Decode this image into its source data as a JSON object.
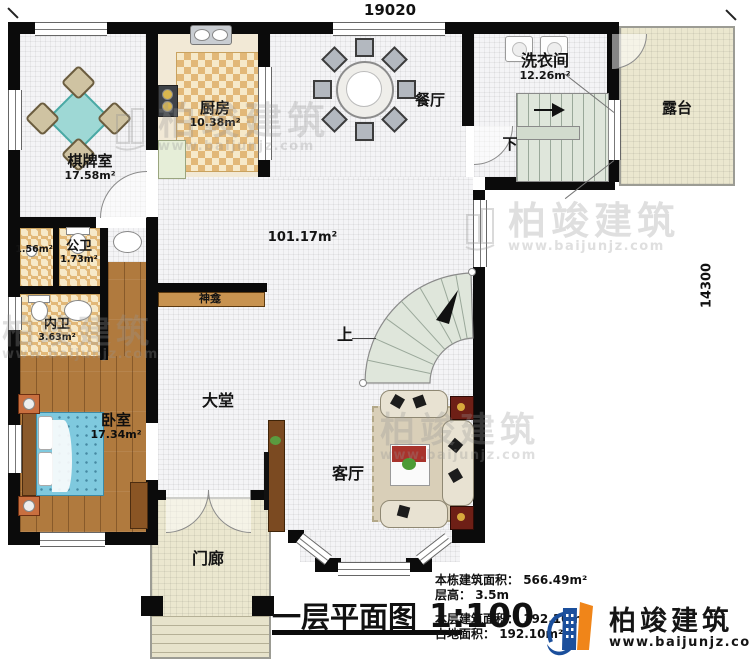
{
  "dimensions": {
    "top": "19020",
    "right": "14300"
  },
  "rooms": {
    "chess": {
      "name": "棋牌室",
      "area": "17.58m²"
    },
    "kitchen": {
      "name": "厨房",
      "area": "10.38m²"
    },
    "dining": {
      "name": "餐厅"
    },
    "laundry": {
      "name": "洗衣间",
      "area": "12.26m²"
    },
    "terrace": {
      "name": "露台"
    },
    "hall": {
      "area": "101.17m²"
    },
    "shower": {
      "area": "1.56m²"
    },
    "public_bath": {
      "name": "公卫",
      "area": "1.73m²"
    },
    "inner_bath": {
      "name": "内卫",
      "area": "3.63m²"
    },
    "bedroom": {
      "name": "卧室",
      "area": "17.34m²"
    },
    "lobby": {
      "name": "大堂"
    },
    "shrine": {
      "name": "神龛"
    },
    "living": {
      "name": "客厅"
    },
    "porch": {
      "name": "门廊"
    }
  },
  "stairs": {
    "up": "上",
    "down": "下"
  },
  "title": {
    "text": "一层平面图",
    "scale": "1:100"
  },
  "stats": [
    {
      "label": "本栋建筑面积：",
      "value": "566.49m²"
    },
    {
      "label": "层高：",
      "value": "3.5m"
    },
    {
      "label": "本层建筑面积：",
      "value": "192.10m²"
    },
    {
      "label": "占地面积：",
      "value": "192.10m²"
    }
  ],
  "brand": {
    "name": "柏竣建筑",
    "site": "www.baijunjz.com"
  },
  "watermark": {
    "name": "柏竣建筑",
    "site": "www.baijunjz.com"
  },
  "colors": {
    "wall": "#0b0b0b",
    "brand_blue": "#1b4f9c",
    "brand_orange": "#f08519",
    "stair_green": "#dfe6db",
    "wood": "#b07a3e",
    "bed_blue": "#7fc9de",
    "table_teal": "#9ed8d5",
    "terrace_beige": "#ebe7cf",
    "checker_tan": "#e2b878",
    "cabinet_red": "#6e1f16"
  }
}
